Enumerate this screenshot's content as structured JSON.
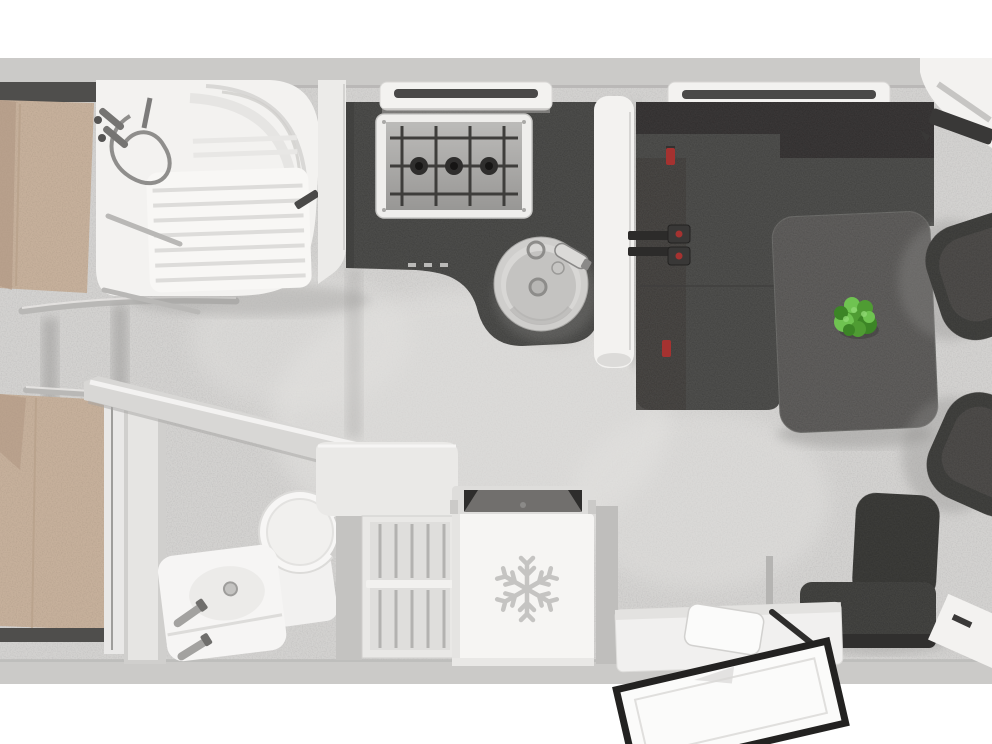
{
  "scene": {
    "title": "Caravan interior floor plan — top-down 3D render",
    "areas": [
      {
        "name": "twin-bedroom",
        "items": [
          "bed-1",
          "bed-2",
          "bed-rails",
          "wardrobe-panel"
        ]
      },
      {
        "name": "shower-room",
        "items": [
          "shower-enclosure",
          "ridged-shower-tray",
          "shower-mixer-hose",
          "grab-rails"
        ]
      },
      {
        "name": "kitchen",
        "items": [
          "dark-worktop",
          "gas-hob-3-burner",
          "round-sink",
          "faucet",
          "overhead-window"
        ]
      },
      {
        "name": "washroom",
        "items": [
          "angled-partition-wall",
          "toilet",
          "washbasin",
          "twin-taps"
        ]
      },
      {
        "name": "dinette",
        "items": [
          "l-shaped-sofa",
          "seat-belt-brackets",
          "dining-table",
          "green-plant",
          "overhead-window"
        ]
      },
      {
        "name": "cab",
        "items": [
          "captain-chair-upper",
          "captain-chair-lower",
          "corner-window",
          "dashboard-element"
        ]
      },
      {
        "name": "galley-block",
        "items": [
          "fridge-with-snowflake",
          "top-vent",
          "slatted-cabinet",
          "corner-shelf"
        ]
      },
      {
        "name": "entrance",
        "items": [
          "entry-step-platform",
          "step-box",
          "entry-door",
          "side-seat"
        ]
      }
    ]
  },
  "icons": {
    "fridge_badge": "snowflake-icon",
    "fridge_glyph": "❄"
  },
  "colors": {
    "page": "#ffffff",
    "brightwhite": "#fafaf9",
    "wall": "#cbcac8",
    "walledge": "#b2b1af",
    "floor": "#d3d2d0",
    "floorlight": "#e3e2e0",
    "white": "#f3f2f0",
    "mattress": "#c6b09b",
    "mattressdark": "#ad9480",
    "headboard": "#4f4e4c",
    "metal": "#b9b8b6",
    "counter": "#4e4d4b",
    "sofadark": "#3a3937",
    "bench": "#504f4d",
    "table": "#615f5d",
    "chair": "#434240",
    "chairin": "#4f4e4c",
    "plant1": "#4f9c33",
    "plant2": "#6fc351",
    "plant3": "#3c8526",
    "planthighlight": "#8fd873",
    "red": "#a53230",
    "slot": "#4a4948",
    "fridge": "#f6f5f3",
    "vent": "#716f6d",
    "ventdark": "#2e2d2c",
    "snowflake": "#c5c4c2",
    "cabinet": "#e9e8e6",
    "slat": "#b3b2b0",
    "graypanel": "#d0cfcd",
    "darkline": "#2c2b2a",
    "hobinner": "#a8a7a5",
    "hobgrid": "#3e3d3b",
    "burner": "#2f2e2d",
    "sink": "#cfcecc",
    "sinkbowl": "#c4c3c1",
    "toiletwhite": "#f7f6f5",
    "doorframe": "#232221",
    "shadow": "#8f8e8c"
  }
}
